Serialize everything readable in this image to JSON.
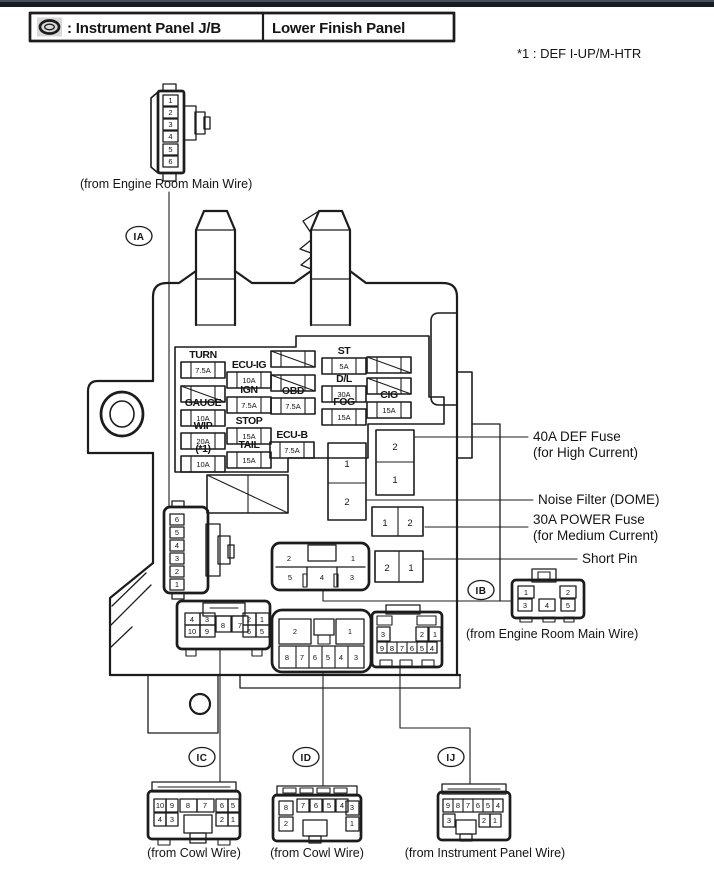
{
  "title_bar": {
    "icon": "junction-block-oval-icon",
    "left": ": Instrument Panel J/B",
    "right": "Lower Finish Panel"
  },
  "note": "*1 : DEF I-UP/M-HTR",
  "refs": {
    "ia": "IA",
    "ib": "IB",
    "ic": "IC",
    "id": "ID",
    "ij": "IJ"
  },
  "wires": {
    "ia": "(from Engine Room Main Wire)",
    "ib": "(from Engine Room Main Wire)",
    "ic": "(from Cowl Wire)",
    "id": "(from Cowl Wire)",
    "ij": "(from Instrument Panel Wire)"
  },
  "fuses": [
    {
      "name": "TURN",
      "amp": "7.5A"
    },
    {
      "name": "GAUGE",
      "amp": "10A"
    },
    {
      "name": "WIP",
      "amp": "20A"
    },
    {
      "name": "(*1)",
      "amp": "10A"
    },
    {
      "name": "ECU-IG",
      "amp": "10A"
    },
    {
      "name": "IGN",
      "amp": "7.5A"
    },
    {
      "name": "STOP",
      "amp": "15A"
    },
    {
      "name": "TAIL",
      "amp": "15A"
    },
    {
      "name": "OBD",
      "amp": "7.5A"
    },
    {
      "name": "ECU-B",
      "amp": "7.5A"
    },
    {
      "name": "ST",
      "amp": "5A"
    },
    {
      "name": "D/L",
      "amp": "30A"
    },
    {
      "name": "FOG",
      "amp": "15A"
    },
    {
      "name": "CIG",
      "amp": "15A"
    }
  ],
  "blocks": {
    "noise_filter": [
      "1",
      "2"
    ],
    "def_fuse": [
      "2",
      "1"
    ],
    "power_fuse": [
      "1",
      "2"
    ],
    "short_pin": [
      "2",
      "1"
    ]
  },
  "callouts": [
    {
      "line1": "40A DEF Fuse",
      "line2": "(for High Current)"
    },
    {
      "line1": "Noise Filter (DOME)",
      "line2": ""
    },
    {
      "line1": "30A POWER Fuse",
      "line2": "(for Medium Current)"
    },
    {
      "line1": "Short Pin",
      "line2": ""
    }
  ],
  "pins": {
    "ia_plug": [
      "1",
      "2",
      "3",
      "4",
      "5",
      "6"
    ],
    "ia_socket": [
      "6",
      "5",
      "4",
      "3",
      "2",
      "1"
    ],
    "ib_socket_top": [
      "2",
      "1"
    ],
    "ib_socket_bot": [
      "5",
      "4",
      "3"
    ],
    "ib_plug_top": [
      "1",
      "2"
    ],
    "ib_plug_bot": [
      "3",
      "4",
      "5"
    ],
    "ic_socket": [
      "4",
      "3",
      "10",
      "9",
      "8",
      "7",
      "2",
      "1",
      "6",
      "5"
    ],
    "ic_plug_top": [
      "10",
      "9",
      "8",
      "7",
      "6",
      "5"
    ],
    "ic_plug_bot": [
      "4",
      "3",
      "2",
      "1"
    ],
    "id_socket_top": [
      "2",
      "1"
    ],
    "id_socket_bot": [
      "8",
      "7",
      "6",
      "5",
      "4",
      "3"
    ],
    "id_plug": [
      "8",
      "2",
      "7",
      "6",
      "5",
      "4",
      "3",
      "1"
    ],
    "ij_socket_top": [
      "3",
      "2",
      "1"
    ],
    "ij_socket_bot": [
      "9",
      "8",
      "7",
      "6",
      "5",
      "4"
    ],
    "ij_plug_top": [
      "9",
      "8",
      "7",
      "6",
      "5",
      "4"
    ],
    "ij_plug_bot": [
      "3",
      "2",
      "1"
    ]
  }
}
